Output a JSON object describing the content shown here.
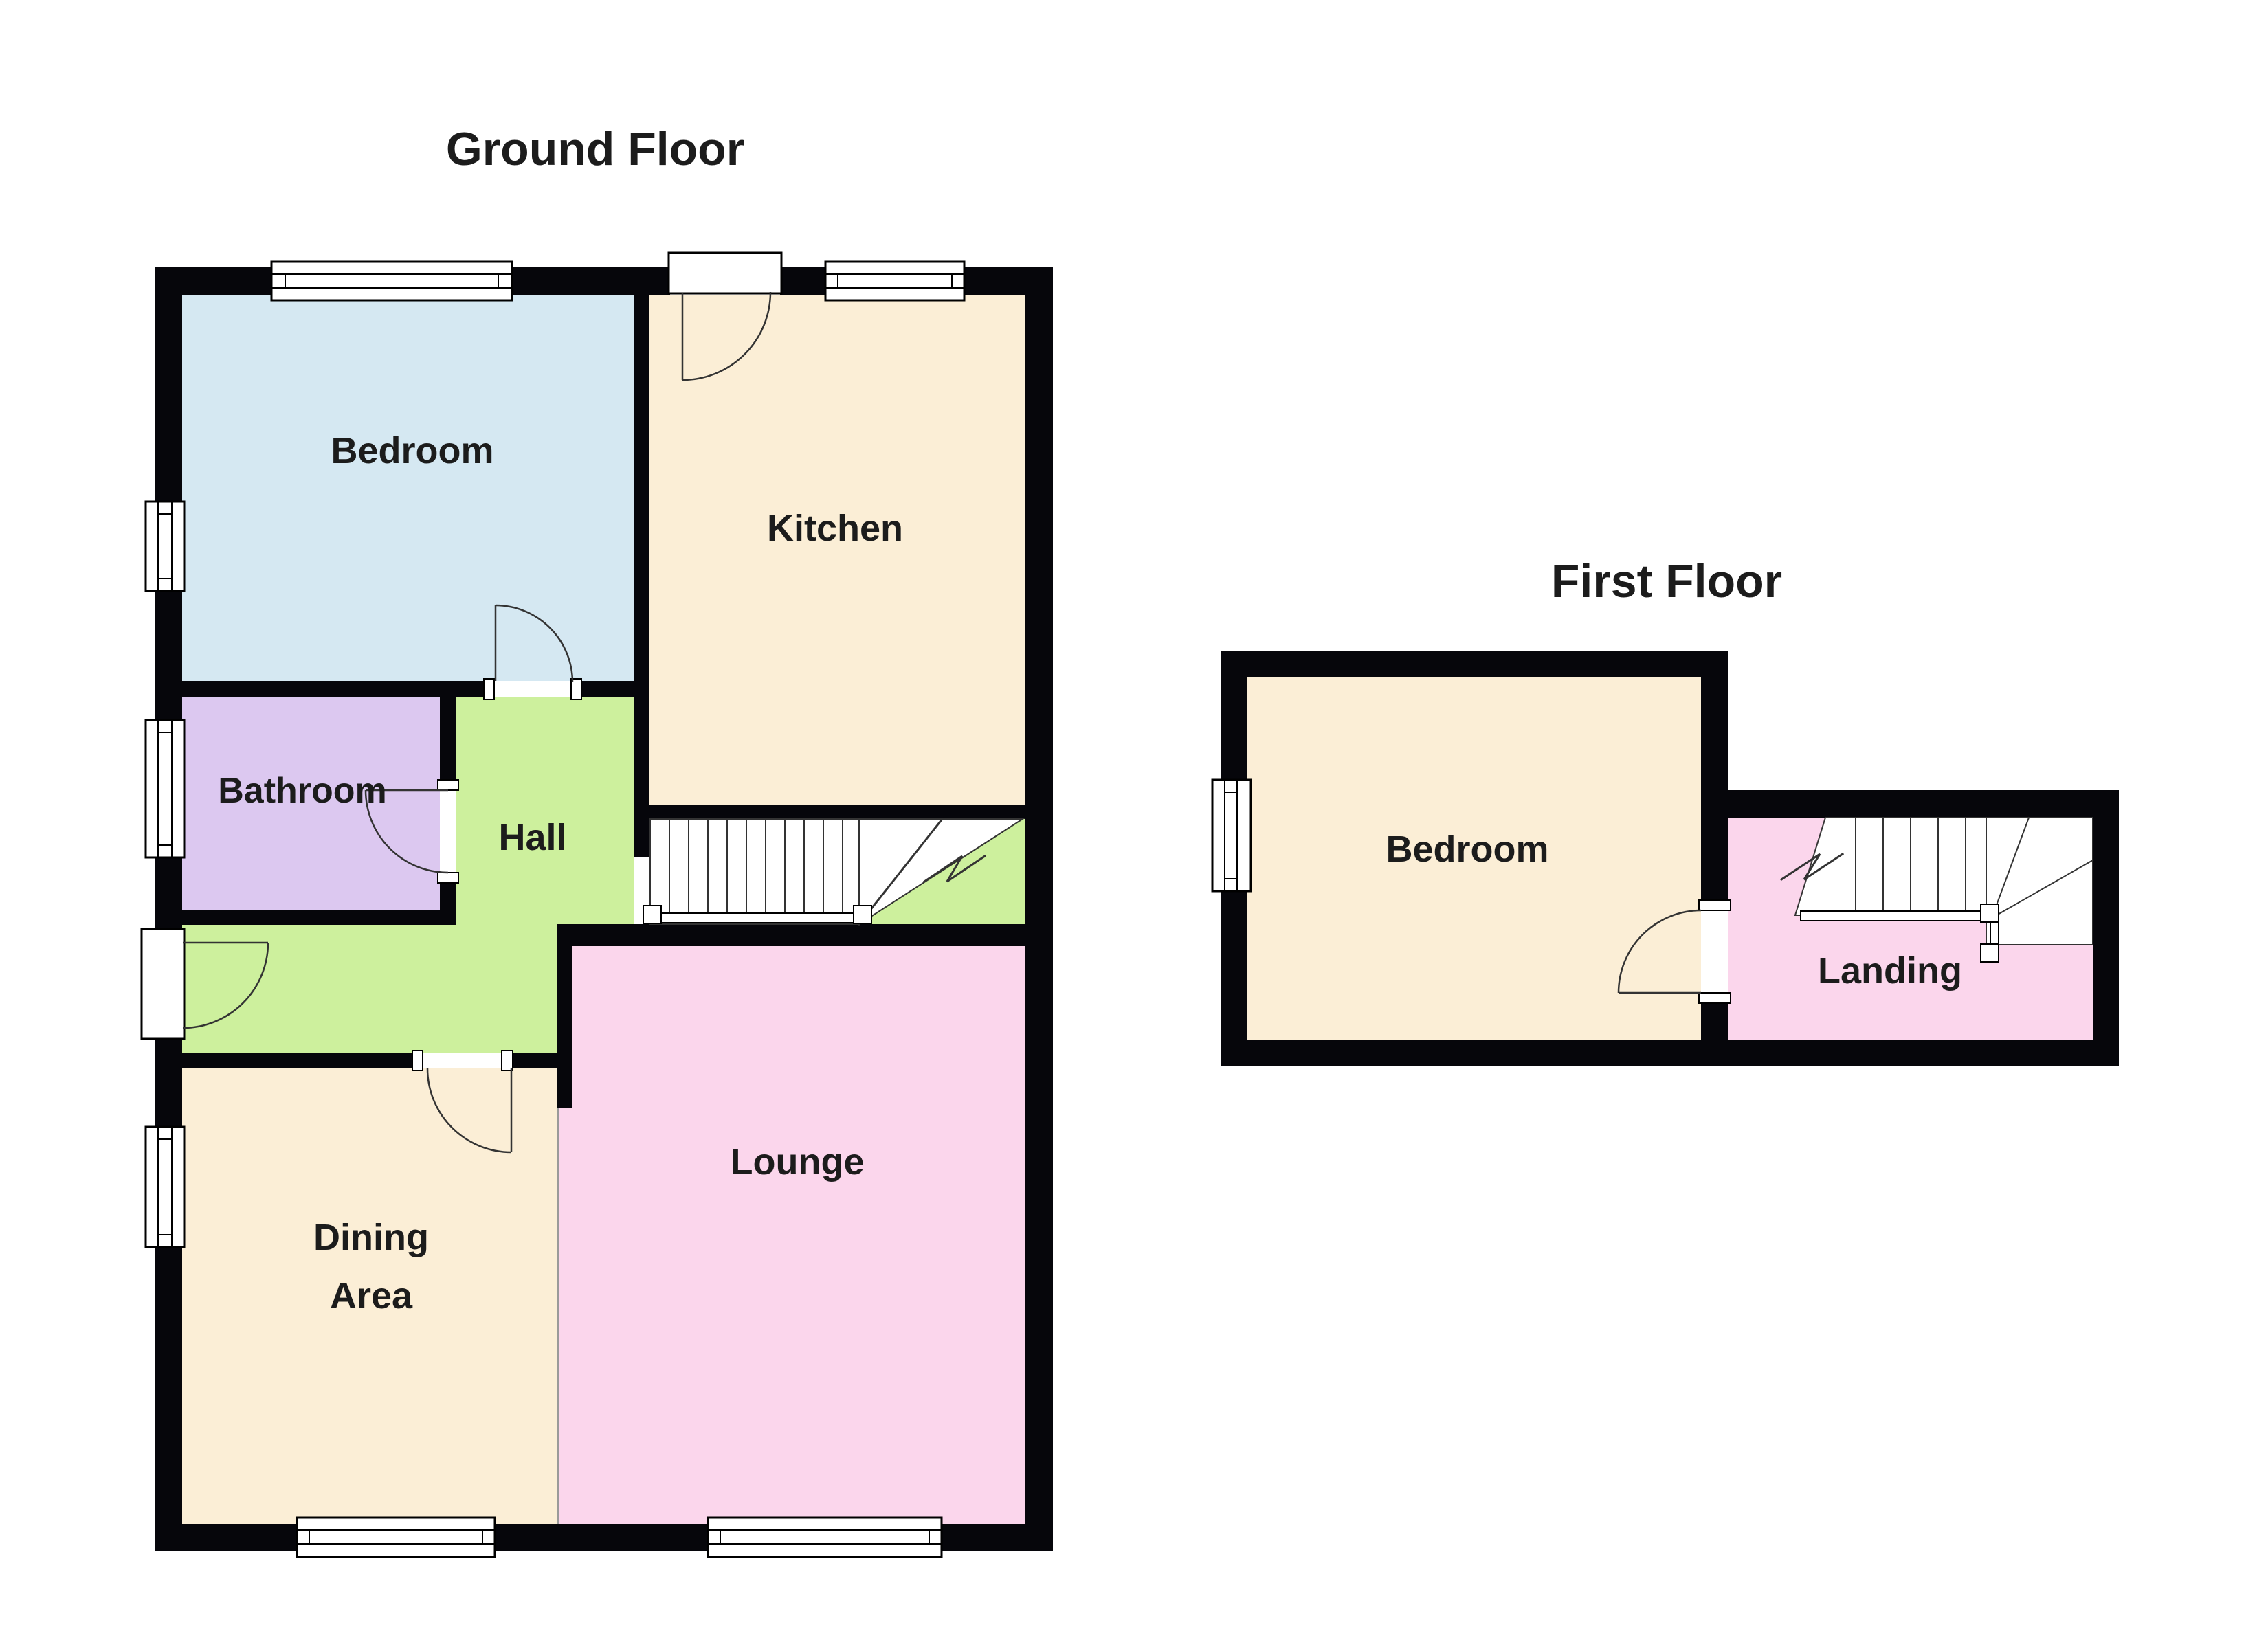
{
  "titles": {
    "ground": "Ground Floor",
    "first": "First Floor"
  },
  "ground_floor": {
    "bedroom": "Bedroom",
    "kitchen": "Kitchen",
    "bathroom": "Bathroom",
    "hall": "Hall",
    "dining_line1": "Dining",
    "dining_line2": "Area",
    "lounge": "Lounge"
  },
  "first_floor": {
    "bedroom": "Bedroom",
    "landing": "Landing"
  },
  "colors": {
    "wall": "#06060b",
    "bedroom_blue": "#d5e8f2",
    "kitchen_cream": "#fbeed6",
    "bathroom_purple": "#dcc8f0",
    "hall_green": "#cdf09d",
    "pink": "#fbd6ec",
    "window_fill": "#ffffff",
    "stair_fill": "#ffffff",
    "stair_line": "#333333",
    "divider_line": "#9a9a9a",
    "text": "#1c1c1c"
  }
}
